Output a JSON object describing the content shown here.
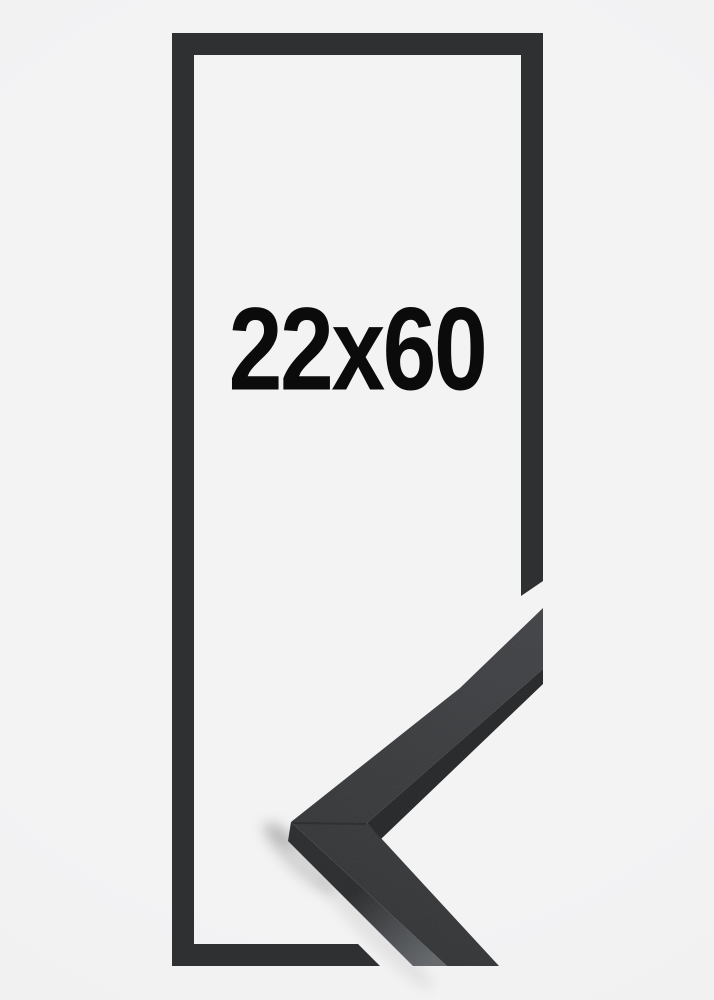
{
  "product": {
    "size_label": "22x60"
  },
  "graphic": {
    "name": "black-picture-frame-outline-with-moulding-corner-sample"
  },
  "colors": {
    "bg": "#f3f3f4",
    "bg_edge": "#eeeeef",
    "frame": "#2e3032",
    "face_light": "#3b3d40",
    "face_dark": "#2b2d2f",
    "edge_dark": "#1e2022",
    "side_top": "#232527",
    "side_bottom": "#5e6164",
    "label": "#0b0b0b",
    "shadow": "#000000"
  }
}
